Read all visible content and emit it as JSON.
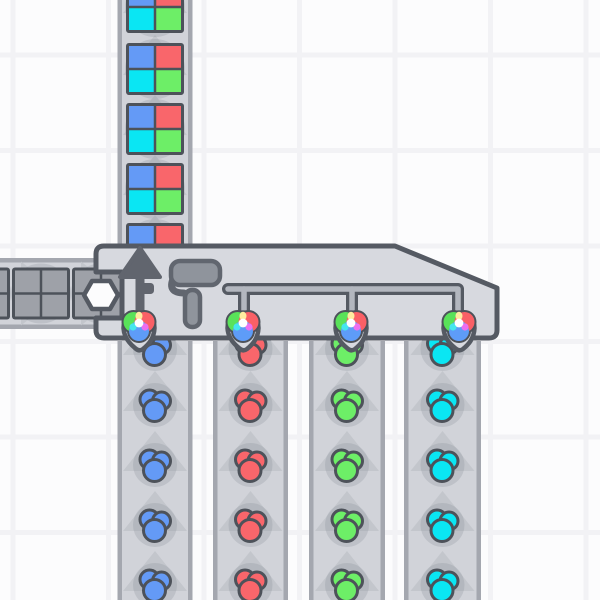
{
  "scene": {
    "app": "shapez-factory",
    "view": "factory-grid",
    "width": 600,
    "height": 600
  },
  "palette": {
    "outline": "#555a63",
    "frame": "#4d525a",
    "building_fill": "#d7d9df",
    "belt_fill": "#d1d3d9",
    "belt_border": "#a4a7af",
    "chevron": "#c3c6cc",
    "shadow": "rgba(125,130,142,0.22)",
    "icon_gray": "#8f949c",
    "icon_gray_outline": "#61666f",
    "arrow_gray": "#61656e",
    "pipe_fill": "#b3b7bf",
    "hex_fill": "#fcfcfd",
    "blue": "#649af6",
    "red": "#f9666b",
    "green": "#6dee67",
    "cyan": "#0ae6f3",
    "gray": "#9ea1a8",
    "emblem_green": "#59e259",
    "emblem_red": "#fa6066",
    "emblem_blue": "#5e9cf8",
    "mix_yellow": "#ffeca0",
    "mix_cyan": "#45e6ee",
    "mix_magenta": "#ec6ff0",
    "mix_white": "#ffffff",
    "bg": "#fcfcfd",
    "grid_line": "#f2f2f5"
  },
  "grid": {
    "spacing": 95.5,
    "offset_x": 10.5,
    "offset_y": 52.5,
    "line_width": 5
  },
  "building": {
    "name": "quad-painter",
    "body": {
      "left": 96,
      "top": 246,
      "bottom": 338,
      "slant_start_x": 395,
      "right": 497,
      "right_top_y": 288,
      "notch": {
        "y1": 272,
        "y2": 318,
        "depth_x": 122
      }
    },
    "hexagon": {
      "cx": 101,
      "cy": 295
    },
    "arrow": {
      "cx": 140,
      "apex_y": 248,
      "base_y": 277,
      "half_width": 20,
      "shaft_bottom": 332,
      "stub": {
        "x": 141,
        "y": 283,
        "w": 13,
        "h": 11
      }
    },
    "roller": {
      "body": {
        "x": 171,
        "y": 261,
        "w": 49,
        "h": 24
      },
      "handle": {
        "x": 185,
        "y": 290,
        "w": 15,
        "h": 37
      }
    },
    "pipe": {
      "y": 289,
      "x1": 228,
      "x2": 458,
      "drop_bottom": 310,
      "drops": [
        244,
        352
      ]
    },
    "color_inputs": [
      {
        "cx": 139
      },
      {
        "cx": 243
      },
      {
        "cx": 351
      },
      {
        "cx": 459
      }
    ]
  },
  "belts": [
    {
      "name": "belt-output-north",
      "axis": "v",
      "x": 117.5,
      "width": 75,
      "from": 0,
      "to": 246,
      "direction": "up",
      "window_colors": [
        "blue",
        "red",
        "cyan",
        "green"
      ],
      "items": [
        {
          "type": "window",
          "c": 7
        },
        {
          "type": "window",
          "c": 69
        },
        {
          "type": "window",
          "c": 129
        },
        {
          "type": "window",
          "c": 189
        },
        {
          "type": "window",
          "c": 249
        }
      ]
    },
    {
      "name": "belt-input-west",
      "axis": "h",
      "y": 258,
      "height": 71,
      "from": 0,
      "to": 97,
      "fill_to": 124,
      "direction": "right",
      "window_colors": [
        "gray",
        "gray",
        "gray",
        "gray"
      ],
      "items": [
        {
          "type": "window",
          "c": -19
        },
        {
          "type": "window",
          "c": 41
        },
        {
          "type": "window",
          "c": 101
        }
      ]
    },
    {
      "name": "belt-color-blue",
      "axis": "v",
      "x": 117.5,
      "width": 75,
      "from": 341,
      "to": 600,
      "direction": "up",
      "dot_color": "blue",
      "items": [
        {
          "type": "dot",
          "c": 349
        },
        {
          "type": "dot",
          "c": 405
        },
        {
          "type": "dot",
          "c": 465
        },
        {
          "type": "dot",
          "c": 525
        },
        {
          "type": "dot",
          "c": 585
        }
      ]
    },
    {
      "name": "belt-color-red",
      "axis": "v",
      "x": 213,
      "width": 75,
      "from": 341,
      "to": 600,
      "direction": "up",
      "dot_color": "red",
      "items": [
        {
          "type": "dot",
          "c": 349
        },
        {
          "type": "dot",
          "c": 405
        },
        {
          "type": "dot",
          "c": 465
        },
        {
          "type": "dot",
          "c": 525
        },
        {
          "type": "dot",
          "c": 585
        }
      ]
    },
    {
      "name": "belt-color-green",
      "axis": "v",
      "x": 309,
      "width": 76,
      "from": 341,
      "to": 600,
      "direction": "up",
      "dot_color": "green",
      "items": [
        {
          "type": "dot",
          "c": 349
        },
        {
          "type": "dot",
          "c": 405
        },
        {
          "type": "dot",
          "c": 465
        },
        {
          "type": "dot",
          "c": 525
        },
        {
          "type": "dot",
          "c": 585
        }
      ]
    },
    {
      "name": "belt-color-cyan",
      "axis": "v",
      "x": 404,
      "width": 77,
      "from": 341,
      "to": 600,
      "direction": "up",
      "dot_color": "cyan",
      "items": [
        {
          "type": "dot",
          "c": 349
        },
        {
          "type": "dot",
          "c": 405
        },
        {
          "type": "dot",
          "c": 465
        },
        {
          "type": "dot",
          "c": 525
        },
        {
          "type": "dot",
          "c": 585
        }
      ]
    }
  ]
}
